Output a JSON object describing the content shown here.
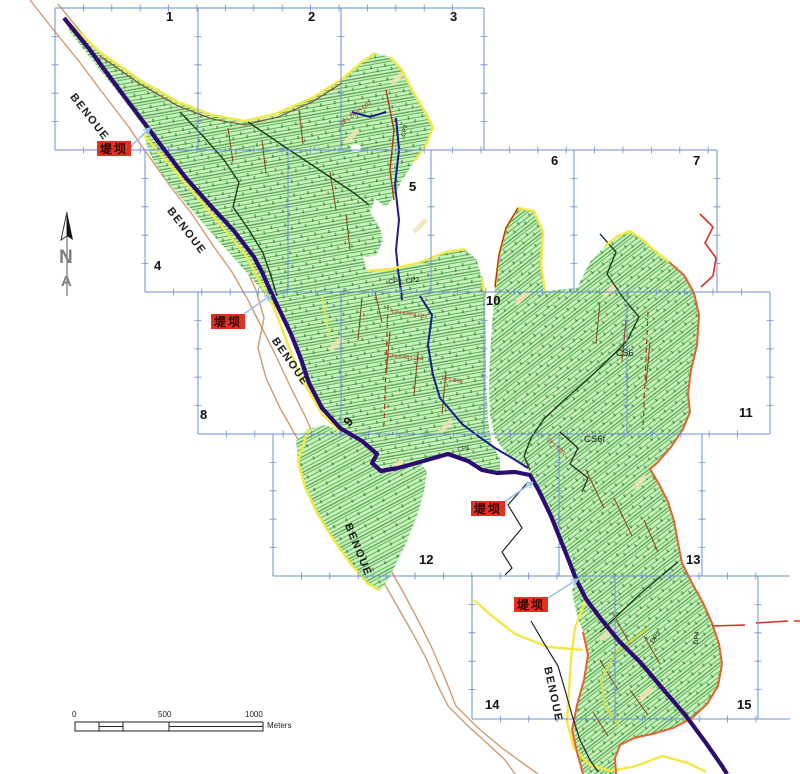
{
  "map": {
    "sheets": [
      {
        "label": "1",
        "x": 166,
        "y": 10,
        "rot": 0
      },
      {
        "label": "2",
        "x": 308,
        "y": 10,
        "rot": 0
      },
      {
        "label": "3",
        "x": 450,
        "y": 10,
        "rot": 0
      },
      {
        "label": "4",
        "x": 154,
        "y": 259,
        "rot": 0
      },
      {
        "label": "5",
        "x": 409,
        "y": 180,
        "rot": 0
      },
      {
        "label": "6",
        "x": 551,
        "y": 154,
        "rot": 0
      },
      {
        "label": "7",
        "x": 693,
        "y": 154,
        "rot": 0
      },
      {
        "label": "8",
        "x": 200,
        "y": 408,
        "rot": 0
      },
      {
        "label": "9",
        "x": 341,
        "y": 420,
        "rot": -50
      },
      {
        "label": "10",
        "x": 486,
        "y": 294,
        "rot": 0
      },
      {
        "label": "11",
        "x": 739,
        "y": 406,
        "rot": 0
      },
      {
        "label": "12",
        "x": 419,
        "y": 553,
        "rot": 0
      },
      {
        "label": "13",
        "x": 686,
        "y": 553,
        "rot": 0
      },
      {
        "label": "14",
        "x": 485,
        "y": 698,
        "rot": 0
      },
      {
        "label": "15",
        "x": 737,
        "y": 698,
        "rot": 0
      }
    ],
    "river": {
      "name": "BENOUE",
      "labels": [
        {
          "x": 76,
          "y": 92,
          "rot": 52
        },
        {
          "x": 173,
          "y": 206,
          "rot": 52
        },
        {
          "x": 278,
          "y": 336,
          "rot": 55
        },
        {
          "x": 352,
          "y": 522,
          "rot": 68
        },
        {
          "x": 552,
          "y": 666,
          "rot": 78
        }
      ]
    },
    "dikes": {
      "text": "堤坝",
      "boxes": [
        {
          "x": 97,
          "y": 141
        },
        {
          "x": 211,
          "y": 314
        },
        {
          "x": 471,
          "y": 501
        },
        {
          "x": 514,
          "y": 597
        }
      ],
      "arrows": [
        {
          "x1": 129,
          "y1": 148,
          "x2": 150,
          "y2": 128
        },
        {
          "x1": 244,
          "y1": 314,
          "x2": 271,
          "y2": 295
        },
        {
          "x1": 504,
          "y1": 502,
          "x2": 533,
          "y2": 482
        },
        {
          "x1": 548,
          "y1": 598,
          "x2": 578,
          "y2": 579
        }
      ]
    },
    "features": [
      {
        "text": "CP1, CP2",
        "x": 388,
        "y": 279,
        "rot": -4,
        "size": 7,
        "bold": false
      },
      {
        "text": "CP1",
        "x": 457,
        "y": 448,
        "rot": -12,
        "size": 6.5,
        "bold": false
      },
      {
        "text": "CP3",
        "x": 401,
        "y": 136,
        "rot": -78,
        "size": 6,
        "bold": false
      },
      {
        "text": "CS6",
        "x": 616,
        "y": 349,
        "rot": 0,
        "size": 9,
        "bold": false
      },
      {
        "text": "CS6f",
        "x": 584,
        "y": 435,
        "rot": 0,
        "size": 9.5,
        "bold": false
      },
      {
        "text": "DP3",
        "x": 650,
        "y": 641,
        "rot": -52,
        "size": 6.5,
        "bold": false
      },
      {
        "text": "DP4",
        "x": 694,
        "y": 644,
        "rot": -85,
        "size": 6.5,
        "bold": false
      }
    ],
    "canal_labels": [
      {
        "text": "CP1-DWH-C02",
        "x": 340,
        "y": 124,
        "rot": -38,
        "size": 5.5
      },
      {
        "text": "CP1-KRP3-CB5",
        "x": 392,
        "y": 310,
        "rot": 8,
        "size": 5
      },
      {
        "text": "CP1-KRP3-CB4",
        "x": 388,
        "y": 354,
        "rot": 6,
        "size": 5
      },
      {
        "text": "CP1-CB5",
        "x": 442,
        "y": 377,
        "rot": 8,
        "size": 5
      },
      {
        "text": "CP1-CB1",
        "x": 548,
        "y": 438,
        "rot": 40,
        "size": 5.5
      }
    ],
    "north": {
      "letters": [
        "N",
        "A"
      ]
    },
    "scale": {
      "ticks": [
        {
          "label": "0",
          "x": 72
        },
        {
          "label": "500",
          "x": 158
        },
        {
          "label": "1000",
          "x": 245
        }
      ],
      "unit": "Meters"
    },
    "colors": {
      "grid_blue": "#6e8fd2",
      "green_base": "#c9f2bc",
      "hatch_green": "#57b457",
      "dike_purple": "#2e0b70",
      "river_tan": "#d29a6e",
      "boundary_yellow": "#f2e945",
      "boundary_orange": "#e2622c",
      "label_red": "#e23120",
      "arrow_blue": "#9cc3ea"
    }
  }
}
